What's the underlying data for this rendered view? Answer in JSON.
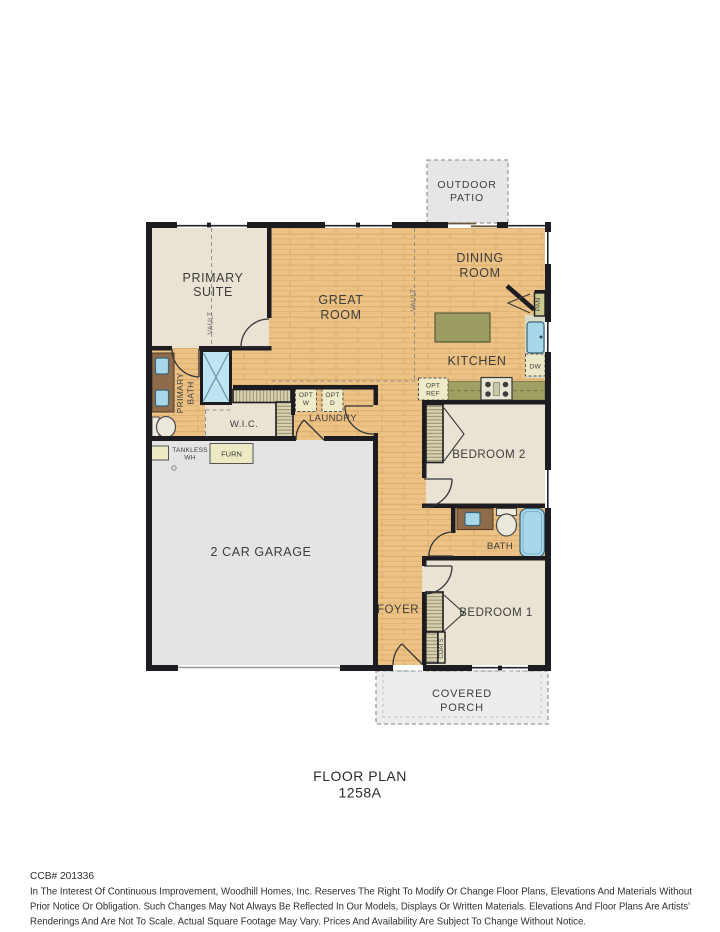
{
  "palette": {
    "wood_floor": "#ecc286",
    "wall": "#1c1c21",
    "room_beige": "#eae3d4",
    "garage_gray": "#e4e4e4",
    "counter_olive": "#9fa163",
    "island_olive": "#9a9c62",
    "fixture_blue": "#a9d7ea",
    "vanity_brown": "#8f6c49",
    "cabinet_cream": "#edebc8",
    "closet_tan": "#d8d2b0",
    "patio_gray": "#e6e6e6",
    "porch_gray": "#ededed"
  },
  "patio": {
    "line1": "OUTDOOR",
    "line2": "PATIO"
  },
  "porch": {
    "line1": "COVERED",
    "line2": "PORCH"
  },
  "rooms": {
    "primary_suite": {
      "line1": "PRIMARY",
      "line2": "SUITE"
    },
    "great_room": {
      "line1": "GREAT",
      "line2": "ROOM"
    },
    "dining_room": {
      "line1": "DINING",
      "line2": "ROOM"
    },
    "kitchen": "KITCHEN",
    "primary_bath": {
      "line1": "PRIMARY",
      "line2": "BATH"
    },
    "wic": "W.I.C.",
    "laundry": "LAUNDRY",
    "garage": "2 CAR GARAGE",
    "bedroom2": "BEDROOM 2",
    "bath": "BATH",
    "bedroom1": "BEDROOM 1",
    "foyer": "FOYER"
  },
  "labels": {
    "vault": "VAULT",
    "pan": "PAN",
    "dw": "DW",
    "opt": "OPT",
    "opt_w": "W",
    "opt_d": "D",
    "opt_ref": "REF",
    "tankless_line1": "TANKLESS",
    "tankless_line2": "WH",
    "furn": "FURN",
    "coats": "COATS"
  },
  "footer": {
    "title": "FLOOR PLAN",
    "plan_number": "1258A",
    "ccb": "CCB# 201336",
    "disclaimer_line1": "In The Interest Of Continuous Improvement, Woodhill Homes, Inc. Reserves The Right To Modify Or Change Floor Plans, Elevations And Materials Without",
    "disclaimer_line2": "Prior Notice Or Obligation. Such Changes May Not Always Be Reflected In Our Models, Displays Or Written Materials. Elevations And Floor Plans Are Artists'",
    "disclaimer_line3": "Renderings And Are Not To Scale. Actual Square Footage May Vary. Prices And Availability Are Subject To Change Without Notice."
  }
}
